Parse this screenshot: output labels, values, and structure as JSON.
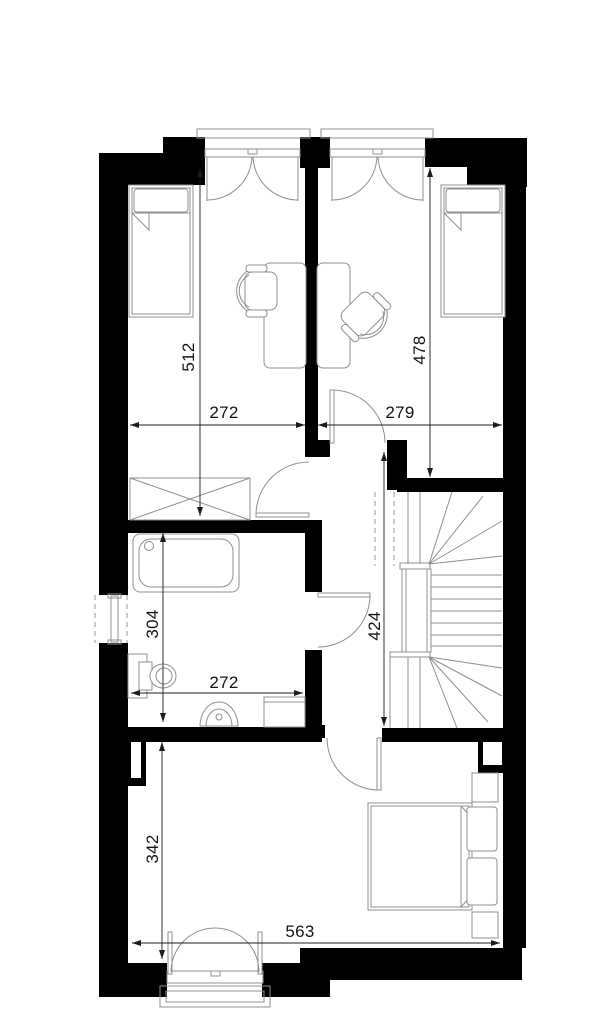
{
  "plan": {
    "title": "floor-plan-upper-storey",
    "dimensions_cm": {
      "bedroom_left_depth": "512",
      "bedroom_left_width": "272",
      "bedroom_right_depth": "478",
      "bedroom_right_width": "279",
      "bathroom_depth": "304",
      "bathroom_width": "272",
      "stair_hall_depth": "424",
      "bedroom_bottom_depth": "342",
      "bedroom_bottom_width": "563"
    },
    "colors": {
      "wall": "#000000",
      "furniture_line": "#8f8f8f",
      "dimension": "#1c1c1c",
      "background": "#ffffff"
    },
    "furniture_icons": [
      "single-bed-icon",
      "desk-icon",
      "office-chair-icon",
      "single-bed-icon",
      "desk-icon",
      "office-chair-icon",
      "wardrobe-icon",
      "bathtub-icon",
      "toilet-icon",
      "washbasin-icon",
      "cabinet-icon",
      "winder-staircase-icon",
      "double-bed-icon",
      "nightstand-icon",
      "nightstand-icon",
      "casement-window-icon",
      "casement-window-icon",
      "side-window-icon",
      "double-entry-door-icon",
      "swing-door-icon"
    ]
  }
}
